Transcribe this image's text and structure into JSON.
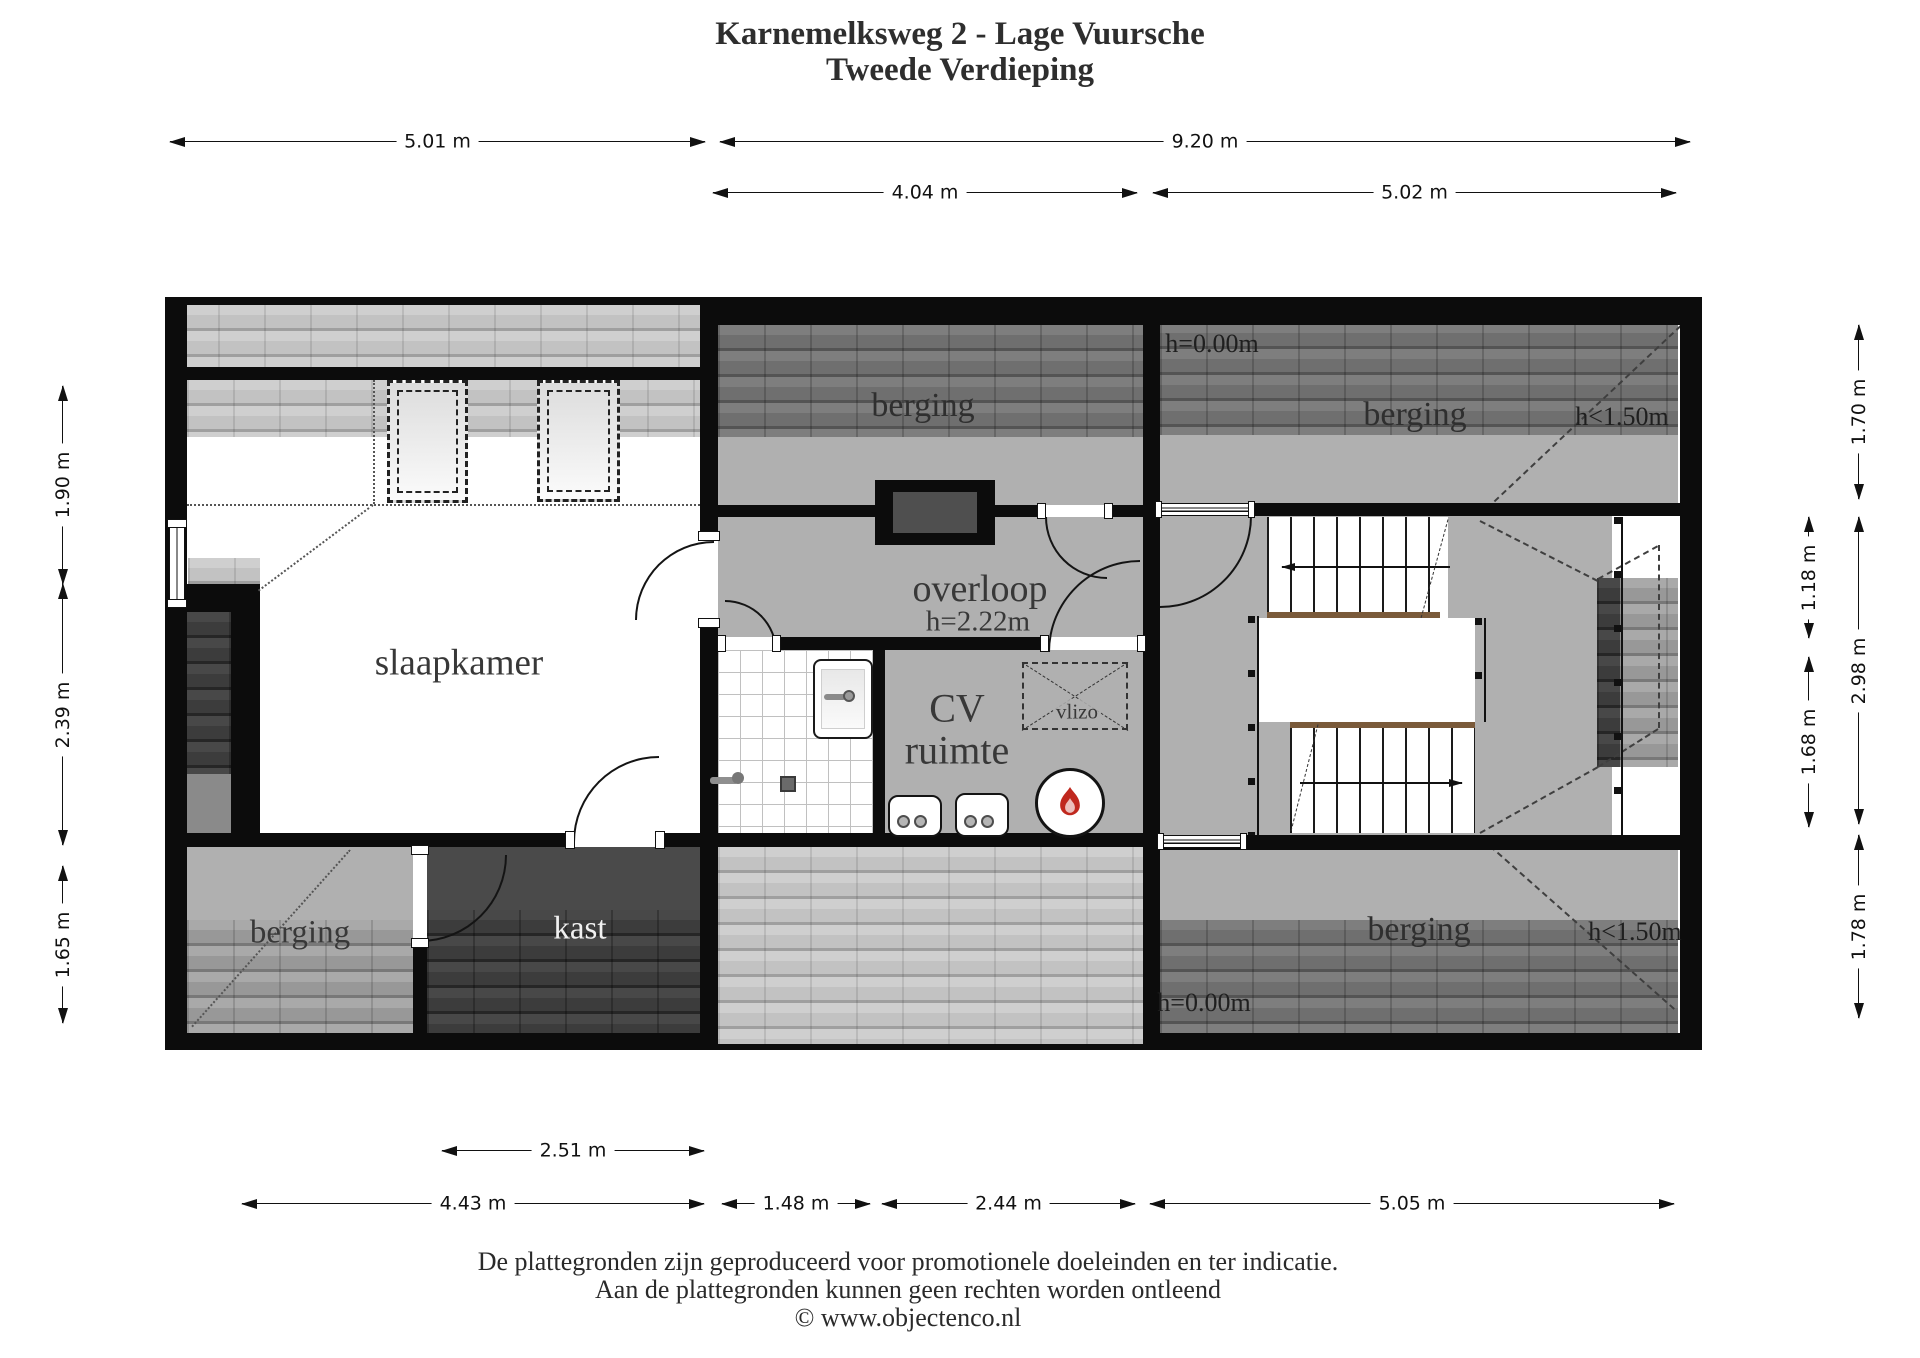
{
  "title": {
    "line1": "Karnemelksweg 2 - Lage Vuursche",
    "line2": "Tweede Verdieping"
  },
  "dimensions": {
    "top": [
      {
        "label": "5.01 m"
      },
      {
        "label": "9.20 m"
      },
      {
        "label": "4.04 m"
      },
      {
        "label": "5.02 m"
      }
    ],
    "left": [
      {
        "label": "1.90 m"
      },
      {
        "label": "2.39 m"
      },
      {
        "label": "1.65 m"
      }
    ],
    "right_inner": [
      {
        "label": "1.18 m"
      },
      {
        "label": "1.68 m"
      }
    ],
    "right_outer": [
      {
        "label": "1.70 m"
      },
      {
        "label": "2.98 m"
      },
      {
        "label": "1.78 m"
      }
    ],
    "bottom": [
      {
        "label": "2.51 m"
      },
      {
        "label": "4.43 m"
      },
      {
        "label": "1.48 m"
      },
      {
        "label": "2.44 m"
      },
      {
        "label": "5.05 m"
      }
    ]
  },
  "rooms": {
    "slaapkamer": {
      "label": "slaapkamer"
    },
    "berging_top_middle": {
      "label": "berging"
    },
    "berging_top_right": {
      "label": "berging",
      "height_left": "h=0.00m",
      "height_right": "h<1.50m"
    },
    "berging_bottom_left": {
      "label": "berging"
    },
    "berging_bottom_right": {
      "label": "berging",
      "height_right": "h<1.50m",
      "height_bottom": "h=0.00m"
    },
    "overloop": {
      "label": "overloop",
      "ceiling_height": "h=2.22m"
    },
    "cv_ruimte": {
      "line1": "CV",
      "line2": "ruimte"
    },
    "kast": {
      "label": "kast"
    },
    "vlizo": {
      "label": "vlizo"
    }
  },
  "footer": {
    "line1": "De plattegronden zijn geproduceerd voor promotionele doeleinden en ter indicatie.",
    "line2": "Aan de plattegronden kunnen geen rechten worden ontleend",
    "line3": "© www.objectenco.nl"
  },
  "colors": {
    "wall": "#0c0c0c",
    "floor_gray": "#b0b0b0",
    "tile_light": "#c9c9c9",
    "tile_dark": "#757575",
    "stair_nosing": "#7a5a3a",
    "flame_red": "#c0281e"
  }
}
